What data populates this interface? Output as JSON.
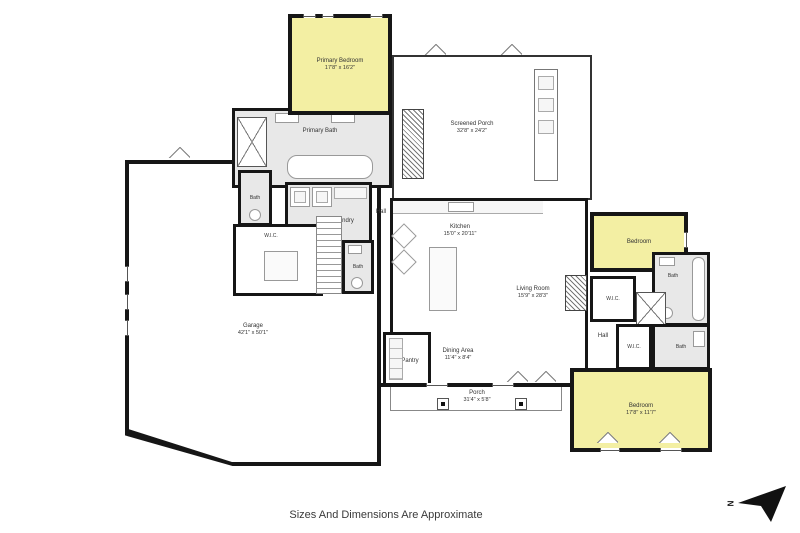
{
  "plan": {
    "footer_note": "Sizes And Dimensions Are Approximate",
    "compass_letter": "N"
  },
  "rooms": {
    "primary_bedroom": {
      "name": "Primary Bedroom",
      "dims": "17'8\" x 16'2\""
    },
    "screened_porch": {
      "name": "Screened Porch",
      "dims": "32'8\" x 24'2\""
    },
    "primary_bath": {
      "name": "Primary Bath"
    },
    "bath_hall": {
      "name": "Bath"
    },
    "laundry": {
      "name": "Laundry"
    },
    "hall_center": {
      "name": "Hall"
    },
    "wic_primary": {
      "name": "W.I.C."
    },
    "bath_stairs": {
      "name": "Bath"
    },
    "kitchen": {
      "name": "Kitchen",
      "dims": "15'0\" x 20'11\""
    },
    "living_room": {
      "name": "Living Room",
      "dims": "15'9\" x 28'3\""
    },
    "bedroom_right": {
      "name": "Bedroom"
    },
    "bath_right_upper": {
      "name": "Bath"
    },
    "wic_right_upper": {
      "name": "W.I.C."
    },
    "hall_right": {
      "name": "Hall"
    },
    "wic_right_lower": {
      "name": "W.I.C."
    },
    "bath_right_lower": {
      "name": "Bath"
    },
    "bedroom_lower": {
      "name": "Bedroom",
      "dims": "17'8\" x 11'7\""
    },
    "garage": {
      "name": "Garage",
      "dims": "42'1\" x 50'1\""
    },
    "pantry": {
      "name": "Pantry"
    },
    "dining_area": {
      "name": "Dining Area",
      "dims": "11'4\" x 8'4\""
    },
    "porch": {
      "name": "Porch",
      "dims": "31'4\" x 5'8\""
    }
  }
}
